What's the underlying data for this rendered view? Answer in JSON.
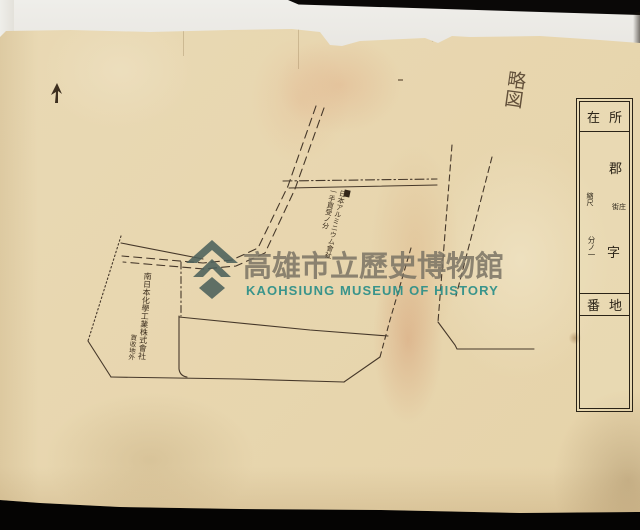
{
  "scan": {
    "background_color": "#050403",
    "bed_color": "#efeeea",
    "paper_color": "#e7d5ac"
  },
  "watermark": {
    "title_zh": "高雄市立歷史博物館",
    "title_en": "KAOHSIUNG MUSEUM OF HISTORY",
    "logo_icon": "museum-logo",
    "logo_color": "#4b605b",
    "zh_color": "#7a7364",
    "en_color": "#2f9089"
  },
  "form": {
    "location_left": "在",
    "location_right": "所",
    "district_label": "郡",
    "town_label": "街庄",
    "aza_label": "字",
    "scale_label": "縮尺",
    "scale_value": "分ノ一",
    "lot_left": "番",
    "lot_right": "地"
  },
  "annotations": {
    "top_right_note": "略図",
    "center_note_line1": "日本アルミニウム會社",
    "center_note_line2": "一手買受ノ分",
    "left_note_main": "南日本化學工業株式會社",
    "left_note_sub": "買收地外"
  },
  "map": {
    "ink_color": "#46382a",
    "north_mark": "arrow-up"
  }
}
